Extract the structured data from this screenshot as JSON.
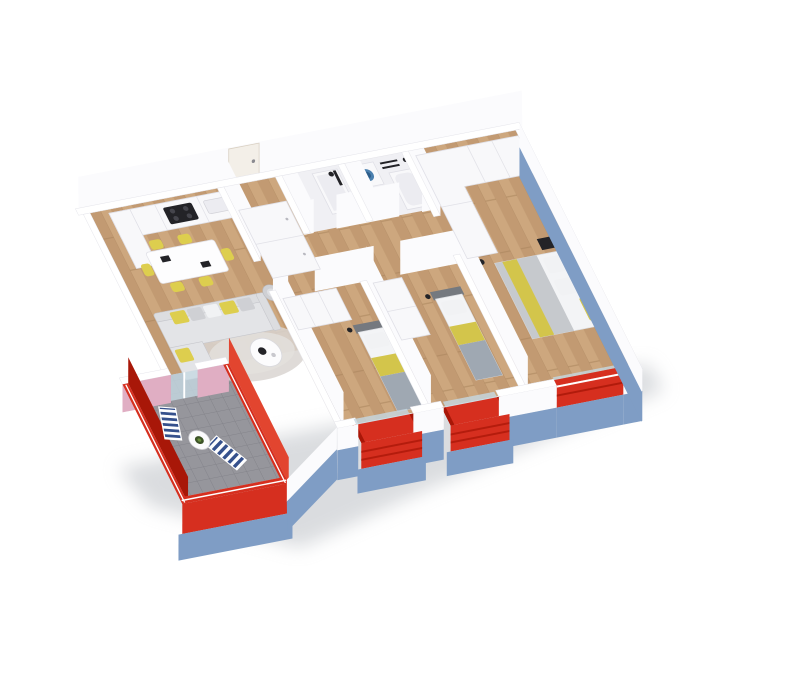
{
  "scene": {
    "type": "3d-floor-plan-render",
    "description": "Isometric 3D cutaway render of a furnished apartment: white walls, red window frames and balcony railings, steel-blue plinth, wood floors, gray terrace",
    "rooms": [
      {
        "id": "kitchen-dining",
        "name": "kitchen-dining",
        "furniture": [
          "kitchen-counter",
          "cooktop",
          "tall-cabinet",
          "dining-table",
          "yellow-chairs"
        ]
      },
      {
        "id": "living-room",
        "name": "living-room",
        "furniture": [
          "corner-sofa",
          "cushions",
          "coffee-table",
          "rug",
          "armchair"
        ]
      },
      {
        "id": "hallway",
        "name": "hallway",
        "furniture": [
          "hall-wardrobe",
          "entry-door"
        ]
      },
      {
        "id": "bathroom-1",
        "name": "bathroom-shower",
        "furniture": [
          "shower",
          "toilet"
        ]
      },
      {
        "id": "bathroom-2",
        "name": "bathroom-laundry",
        "furniture": [
          "washing-machine",
          "towel-radiator",
          "bathtub"
        ]
      },
      {
        "id": "bedroom-master",
        "name": "master-bedroom",
        "furniture": [
          "double-bed",
          "l-shaped-wardrobe",
          "nightstand",
          "floor-lamp"
        ]
      },
      {
        "id": "bedroom-2",
        "name": "bedroom-single-left",
        "furniture": [
          "single-bed",
          "wardrobe"
        ]
      },
      {
        "id": "bedroom-3",
        "name": "bedroom-single-right",
        "furniture": [
          "single-bed",
          "wardrobe"
        ]
      },
      {
        "id": "terrace",
        "name": "terrace",
        "furniture": [
          "lounger",
          "lounger",
          "round-table"
        ]
      },
      {
        "id": "balcony-1",
        "name": "balcony-left"
      },
      {
        "id": "balcony-2",
        "name": "balcony-right"
      },
      {
        "id": "french-balcony",
        "name": "french-balcony"
      }
    ]
  },
  "palette": {
    "background": "#ffffff",
    "wall_white": "#ffffff",
    "wall_face": "#fbfbfd",
    "wall_edge": "#e4e4ea",
    "accent_red": "#d62f1f",
    "accent_red_bright": "#e2452f",
    "accent_red_dark": "#a81708",
    "base_blue": "#7f9dc5",
    "pink_wall": "#e0aec3",
    "glass_blue": "#c6d8e2",
    "wood_light": "#cda77e",
    "wood_mid": "#c29a72",
    "wood_line": "#a8835c",
    "bath_floor": "#f0f0f4",
    "terrace_tile": "#96969c",
    "terrace_tile_line": "#83838a",
    "furniture_white": "#f8f8fa",
    "furniture_edge": "#dfdfe6",
    "sofa_gray": "#dcdde0",
    "cushion_yellow": "#ddce4e",
    "bed_duvet_gray": "#c6c9cd",
    "bed_yellow": "#d3c54b",
    "headboard_gray": "#75797f",
    "black_accent": "#232327",
    "washer_door_blue": "#4a7fae",
    "lounger_stripe_navy": "#35508c",
    "shadow_gray": "#b6bac0"
  }
}
